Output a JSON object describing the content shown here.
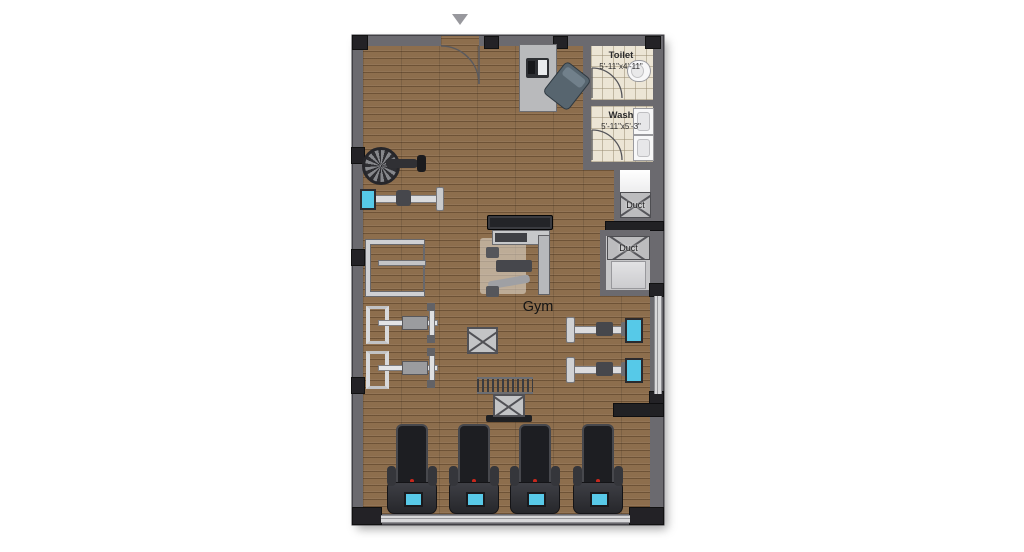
{
  "plan": {
    "type": "gym-floor-plan",
    "main_room_label": "Gym",
    "entrance_marker_icon": "triangle-down-entrance-icon",
    "rooms": [
      {
        "name": "toilet",
        "label": "Toilet",
        "dimensions": "5'-11\"x4'-11\""
      },
      {
        "name": "wash",
        "label": "Wash",
        "dimensions": "5'-11\"x5'-3\""
      },
      {
        "name": "duct-upper",
        "label": "Duct"
      },
      {
        "name": "duct-lower",
        "label": "Duct"
      }
    ],
    "colors": {
      "wall": "#6b6a6f",
      "wood_floor": "#8d6e4d",
      "tile_floor": "#ece5d5",
      "window_band": "#d8d8da",
      "column_dark": "#232226",
      "console_screen": "#56c9e8"
    },
    "equipment": [
      {
        "type": "reception-desk",
        "x": 519,
        "y": 44,
        "w": 36,
        "h": 66
      },
      {
        "type": "office-chair",
        "x": 551,
        "y": 66,
        "w": 30,
        "h": 38,
        "r": 38
      },
      {
        "type": "toilet",
        "x": 627,
        "y": 60,
        "w": 22,
        "h": 20
      },
      {
        "type": "sink",
        "x": 633,
        "y": 108,
        "w": 19,
        "h": 25
      },
      {
        "type": "sink",
        "x": 633,
        "y": 135,
        "w": 19,
        "h": 24
      },
      {
        "type": "spin-bike",
        "x": 362,
        "y": 146,
        "w": 64,
        "h": 36
      },
      {
        "type": "rowing-machine",
        "x": 360,
        "y": 184,
        "w": 84,
        "h": 28
      },
      {
        "type": "squat-rack",
        "x": 366,
        "y": 240,
        "w": 54,
        "h": 48
      },
      {
        "type": "bench-press",
        "x": 366,
        "y": 303,
        "w": 78,
        "h": 38
      },
      {
        "type": "bench-press",
        "x": 366,
        "y": 348,
        "w": 78,
        "h": 38
      },
      {
        "type": "gym-mat",
        "x": 487,
        "y": 215,
        "w": 64,
        "h": 13
      },
      {
        "type": "multi-gym",
        "x": 480,
        "y": 230,
        "w": 78,
        "h": 70
      },
      {
        "type": "crate",
        "x": 467,
        "y": 327,
        "w": 27,
        "h": 23
      },
      {
        "type": "dumbbell-rack",
        "x": 477,
        "y": 377,
        "w": 56,
        "h": 13
      },
      {
        "type": "crate-platform",
        "x": 489,
        "y": 394,
        "w": 40,
        "h": 28
      },
      {
        "type": "weight-bench",
        "x": 566,
        "y": 313,
        "w": 82,
        "h": 32
      },
      {
        "type": "weight-bench",
        "x": 566,
        "y": 353,
        "w": 82,
        "h": 32
      },
      {
        "type": "treadmill",
        "x": 389,
        "y": 424,
        "w": 46,
        "h": 90
      },
      {
        "type": "treadmill",
        "x": 451,
        "y": 424,
        "w": 46,
        "h": 90
      },
      {
        "type": "treadmill",
        "x": 512,
        "y": 424,
        "w": 46,
        "h": 90
      },
      {
        "type": "treadmill",
        "x": 575,
        "y": 424,
        "w": 46,
        "h": 90
      }
    ]
  }
}
